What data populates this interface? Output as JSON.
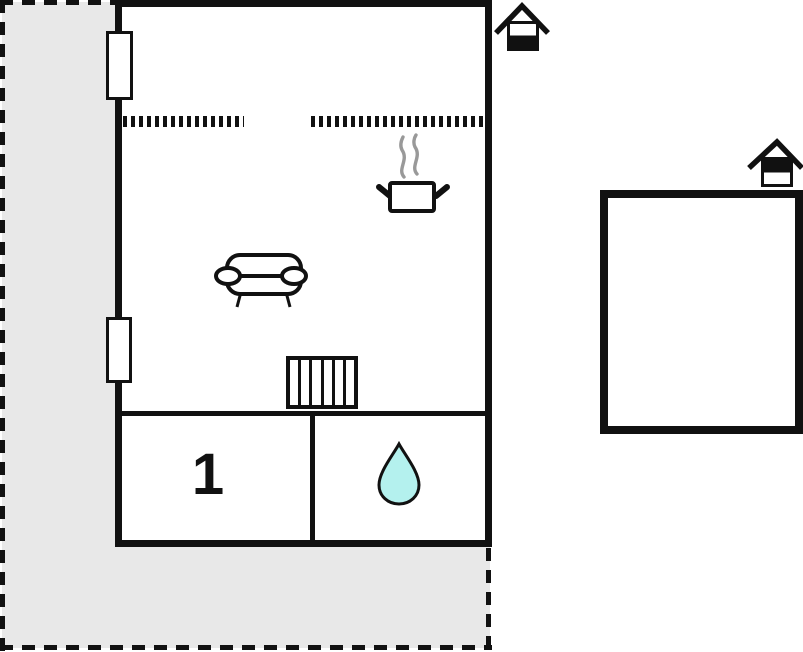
{
  "document": {
    "type": "holiday-home floor plan",
    "text_visible": [
      "1"
    ]
  },
  "colors": {
    "background": "#ffffff",
    "terrace-fill": "#e8e8e8",
    "wall": "#111111",
    "water-drop-fill": "#b4f1ee",
    "steam": "#999999"
  },
  "terrace": {
    "boundary_style": "dashed",
    "fill": "#e8e8e8"
  },
  "main_building": {
    "windows": 2,
    "partial_wall_style": "dotted",
    "living_kitchen_area": {
      "icons": [
        "cooking-pot-icon",
        "steam-icon",
        "sofa-icon",
        "radiator-icon"
      ]
    },
    "rooms": {
      "bedroom": {
        "label": "1"
      },
      "bathroom": {
        "icon": "water-drop-icon"
      }
    },
    "entrance_marker": {
      "icon": "house-entrance-icon",
      "filled_half": "bottom"
    }
  },
  "annex_building": {
    "rooms": {},
    "entrance_marker": {
      "icon": "house-entrance-icon",
      "filled_half": "top"
    }
  }
}
